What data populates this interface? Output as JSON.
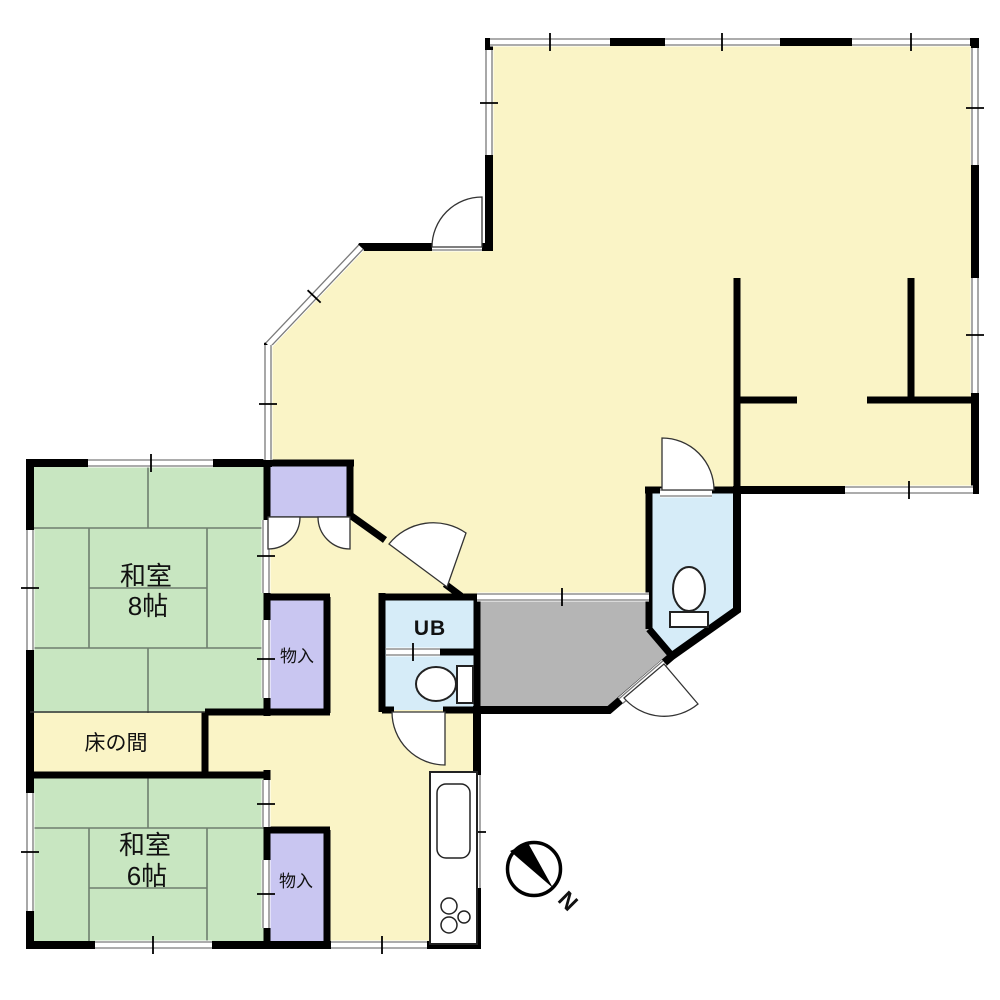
{
  "floor_plan": {
    "rooms": {
      "washitsu_8": {
        "name": "和室",
        "size": "8帖"
      },
      "washitsu_6": {
        "name": "和室",
        "size": "6帖"
      },
      "tokonoma": {
        "label": "床の間"
      },
      "storage_mid": {
        "label": "物入"
      },
      "storage_lower": {
        "label": "物入"
      },
      "unit_bath": {
        "label": "UB"
      }
    },
    "compass": {
      "north": "N"
    },
    "colors": {
      "floor_yellow": "#FAF4C6",
      "tatami_green": "#C8E6C1",
      "closet_purple": "#C9C6F1",
      "wet_area_blue": "#D6ECF8",
      "genkan_gray": "#B5B5B5",
      "wall": "#000000"
    }
  }
}
